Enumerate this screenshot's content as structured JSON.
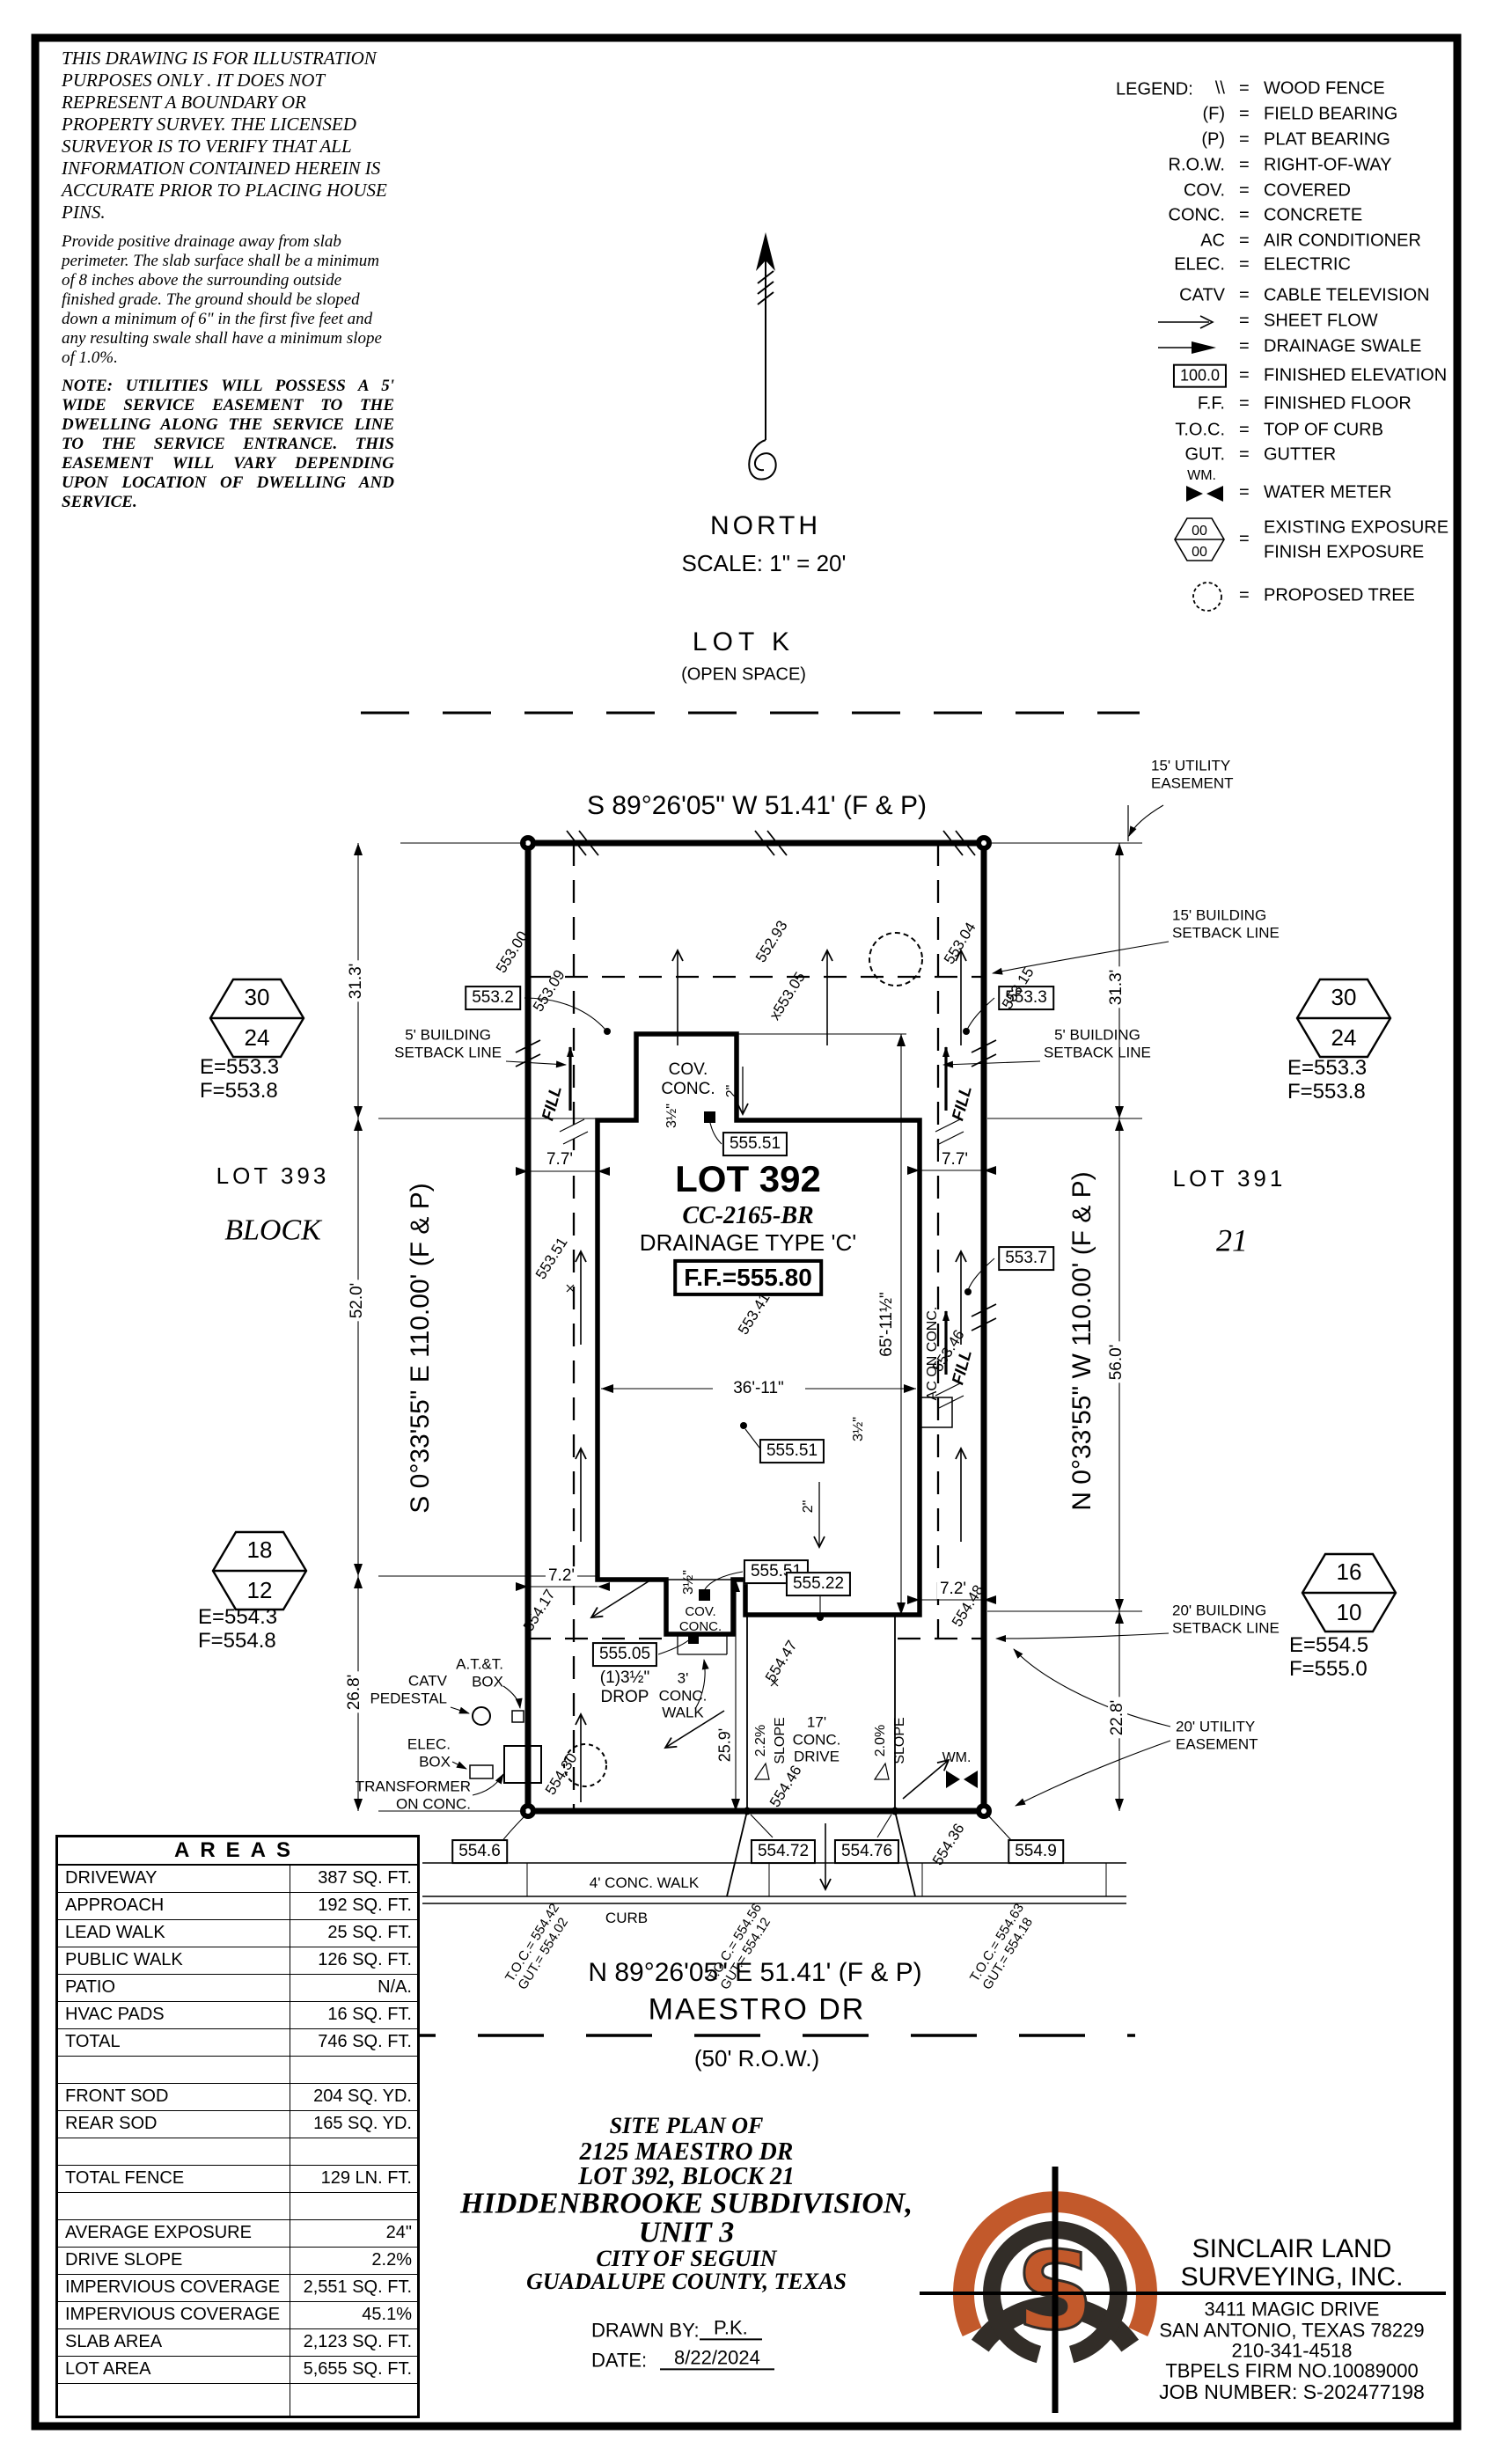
{
  "colors": {
    "ink": "#000000",
    "paper": "#ffffff",
    "logo_orange": "#c2592b",
    "logo_dark": "#322d28"
  },
  "notes": {
    "disclaimer": "THIS DRAWING IS FOR ILLUSTRATION PURPOSES ONLY . IT DOES NOT REPRESENT A BOUNDARY OR PROPERTY SURVEY. THE LICENSED SURVEYOR IS TO VERIFY THAT ALL INFORMATION CONTAINED HEREIN IS ACCURATE PRIOR TO PLACING HOUSE PINS.",
    "drainage": "Provide positive drainage away from slab perimeter. The slab surface shall be a minimum of 8 inches above the surrounding outside finished grade. The ground should be sloped down a minimum of 6\" in the first five feet and any resulting swale shall have a minimum slope of 1.0%.",
    "utilities": "NOTE:  UTILITIES WILL POSSESS A 5' WIDE SERVICE EASEMENT TO THE DWELLING ALONG THE SERVICE LINE TO THE SERVICE ENTRANCE.  THIS EASEMENT WILL VARY DEPENDING UPON LOCATION OF DWELLING AND SERVICE."
  },
  "compass": {
    "label": "NORTH",
    "scale": "SCALE: 1\" = 20'"
  },
  "legend": {
    "title": "LEGEND:",
    "eq": "=",
    "rows": [
      {
        "sym": "\\\\",
        "term": "WOOD FENCE"
      },
      {
        "sym": "(F)",
        "term": "FIELD BEARING"
      },
      {
        "sym": "(P)",
        "term": "PLAT BEARING"
      },
      {
        "sym": "R.O.W.",
        "term": "RIGHT-OF-WAY"
      },
      {
        "sym": "COV.",
        "term": "COVERED"
      },
      {
        "sym": "CONC.",
        "term": "CONCRETE"
      },
      {
        "sym": "AC",
        "term": "AIR CONDITIONER"
      },
      {
        "sym": "ELEC.",
        "term": "ELECTRIC"
      },
      {
        "sym": "CATV",
        "term": "CABLE TELEVISION"
      },
      {
        "sym": "",
        "term": "SHEET FLOW"
      },
      {
        "sym": "",
        "term": "DRAINAGE SWALE"
      },
      {
        "sym": "100.0",
        "term": "FINISHED ELEVATION"
      },
      {
        "sym": "F.F.",
        "term": "FINISHED FLOOR"
      },
      {
        "sym": "T.O.C.",
        "term": "TOP OF CURB"
      },
      {
        "sym": "GUT.",
        "term": "GUTTER"
      },
      {
        "sym": "WM.",
        "term": "WATER METER"
      },
      {
        "sym": "00",
        "sym2": "00",
        "term": "EXISTING EXPOSURE",
        "term2": "FINISH EXPOSURE"
      },
      {
        "sym": "",
        "term": "PROPOSED TREE"
      }
    ]
  },
  "adjacent": {
    "lot_k": "LOT K",
    "open_space": "(OPEN SPACE)",
    "lot_left": "LOT 393",
    "block_left": "BLOCK",
    "lot_right": "LOT 391",
    "block_right": "21"
  },
  "bearings": {
    "north": "S 89°26'05\" W 51.41' (F & P)",
    "south": "N 89°26'05\" E 51.41' (F & P)",
    "west": "S 0°33'55\" E 110.00' (F & P)",
    "east": "N 0°33'55\" W 110.00' (F & P)"
  },
  "street": {
    "name": "MAESTRO DR",
    "row": "(50' R.O.W.)"
  },
  "lot": {
    "title": "LOT 392",
    "cc": "CC-2165-BR",
    "drainage": "DRAINAGE TYPE 'C'",
    "ff": "F.F.=555.80"
  },
  "markers": {
    "nw": {
      "top": "30",
      "bottom": "24",
      "e": "E=553.3",
      "f": "F=553.8"
    },
    "ne": {
      "top": "30",
      "bottom": "24",
      "e": "E=553.3",
      "f": "F=553.8"
    },
    "sw": {
      "top": "18",
      "bottom": "12",
      "e": "E=554.3",
      "f": "F=554.8"
    },
    "se": {
      "top": "16",
      "bottom": "10",
      "e": "E=554.5",
      "f": "F=555.0"
    }
  },
  "callouts": {
    "utility15_1": "15' UTILITY",
    "utility15_2": "EASEMENT",
    "setback15_1": "15' BUILDING",
    "setback15_2": "SETBACK LINE",
    "setback5l_1": "5' BUILDING",
    "setback5l_2": "SETBACK LINE",
    "setback5r_1": "5' BUILDING",
    "setback5r_2": "SETBACK LINE",
    "setback20_1": "20' BUILDING",
    "setback20_2": "SETBACK LINE",
    "utility20_1": "20' UTILITY",
    "utility20_2": "EASEMENT",
    "catv_1": "CATV",
    "catv_2": "PEDESTAL",
    "att_1": "A.T.&T.",
    "att_2": "BOX",
    "elec_1": "ELEC.",
    "elec_2": "BOX",
    "trans_1": "TRANSFORMER",
    "trans_2": "ON CONC.",
    "cov_1": "COV.",
    "cov_2": "CONC.",
    "covb_1": "COV.",
    "covb_2": "CONC.",
    "drop_1": "(1)3½\"",
    "drop_2": "DROP",
    "walk3_1": "3'",
    "walk3_2": "CONC.",
    "walk3_3": "WALK",
    "drive17_1": "17'",
    "drive17_2": "CONC.",
    "drive17_3": "DRIVE",
    "walk4": "4' CONC. WALK",
    "curb": "CURB",
    "ac": "AC ON CONC.",
    "wm": "WM.",
    "fill": "FILL"
  },
  "dims": {
    "d31l": "31.3'",
    "d31r": "31.3'",
    "d52": "52.0'",
    "d56": "56.0'",
    "d26": "26.8'",
    "d22": "22.8'",
    "d77l": "7.7'",
    "d77r": "7.7'",
    "d72l": "7.2'",
    "d72r": "7.2'",
    "d36": "36'-11\"",
    "d65": "65'-11½\"",
    "d25": "25.9'",
    "h_top": "3½\"",
    "h_right": "3½\"",
    "h_bottom": "3½\"",
    "two_a": "2\"",
    "two_b": "2\"",
    "s22": "2.2%",
    "s20": "2.0%",
    "slope": "SLOPE"
  },
  "boxed": {
    "e553_2": "553.2",
    "e553_3": "553.3",
    "e553_7": "553.7",
    "e555_51a": "555.51",
    "e555_51b": "555.51",
    "e555_51c": "555.51",
    "e555_22": "555.22",
    "e555_05": "555.05",
    "e554_6": "554.6",
    "e554_72": "554.72",
    "e554_76": "554.76",
    "e554_9": "554.9"
  },
  "spots": {
    "a": "553.00",
    "b": "553.09",
    "c": "552.93",
    "d": "x553.05",
    "e": "553.04",
    "f": "553.15",
    "g": "553.51",
    "h": "554.17",
    "i": "554.30",
    "j": "553.41",
    "k": "553.46",
    "l": "554.48",
    "m": "554.47",
    "n": "554.46",
    "o": "554.36"
  },
  "toc": {
    "g1a": "T.O.C.= 554.42",
    "g1b": "GUT.= 554.02",
    "g2a": "T.O.C.= 554.56",
    "g2b": "GUT.= 554.12",
    "g3a": "T.O.C.= 554.63",
    "g3b": "GUT.= 554.18"
  },
  "areas_table": {
    "title": "AREAS",
    "rows": [
      {
        "label": "DRIVEWAY",
        "value": "387 SQ. FT."
      },
      {
        "label": "APPROACH",
        "value": "192 SQ. FT."
      },
      {
        "label": "LEAD WALK",
        "value": "25 SQ. FT."
      },
      {
        "label": "PUBLIC WALK",
        "value": "126 SQ. FT."
      },
      {
        "label": "PATIO",
        "value": "N/A."
      },
      {
        "label": "HVAC PADS",
        "value": "16 SQ. FT."
      },
      {
        "label": "TOTAL",
        "value": "746 SQ. FT."
      },
      {
        "label": "",
        "value": ""
      },
      {
        "label": "FRONT SOD",
        "value": "204 SQ. YD."
      },
      {
        "label": "REAR SOD",
        "value": "165 SQ. YD."
      },
      {
        "label": "",
        "value": ""
      },
      {
        "label": "TOTAL FENCE",
        "value": "129 LN. FT."
      },
      {
        "label": "",
        "value": ""
      },
      {
        "label": "AVERAGE EXPOSURE",
        "value": "24\""
      },
      {
        "label": "DRIVE SLOPE",
        "value": "2.2%"
      },
      {
        "label": "IMPERVIOUS COVERAGE",
        "value": "2,551 SQ. FT."
      },
      {
        "label": "IMPERVIOUS COVERAGE %",
        "value": "45.1%"
      },
      {
        "label": "SLAB AREA",
        "value": "2,123 SQ. FT."
      },
      {
        "label": "LOT AREA",
        "value": "5,655 SQ. FT."
      },
      {
        "label": "",
        "value": ""
      }
    ]
  },
  "title_block": {
    "l1": "SITE PLAN OF",
    "l2": "2125 MAESTRO DR",
    "l3": "LOT 392, BLOCK 21",
    "l4": "HIDDENBROOKE SUBDIVISION,",
    "l5": "UNIT 3",
    "l6": "CITY OF SEGUIN",
    "l7": "GUADALUPE COUNTY, TEXAS",
    "drawn_by_label": "DRAWN BY:",
    "drawn_by": "P.K.",
    "date_label": "DATE:",
    "date": "8/22/2024"
  },
  "company": {
    "name_line1": "SINCLAIR LAND",
    "name_line2": "SURVEYING, INC.",
    "logo_letter": "S",
    "address1": "3411 MAGIC DRIVE",
    "address2": "SAN ANTONIO, TEXAS 78229",
    "phone": "210-341-4518",
    "firm": "TBPELS FIRM NO.10089000",
    "job": "JOB NUMBER: S-202477198"
  }
}
